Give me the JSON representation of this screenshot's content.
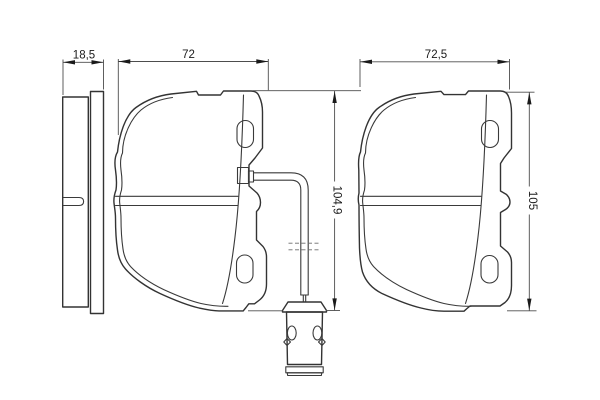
{
  "page": {
    "background": "#ffffff"
  },
  "drawing": {
    "type": "technical-drawing",
    "subject": "disc-brake-pad-set-with-wear-sensor",
    "views": {
      "side_view": {
        "thickness_label": "18,5"
      },
      "left_pad": {
        "width_label": "72",
        "height_label": "104,9"
      },
      "right_pad": {
        "width_label": "72,5",
        "height_label": "105"
      }
    },
    "colors": {
      "outline": "#333333",
      "dimension_line": "#4d4d4d",
      "text": "#1a1a1a",
      "background": "#ffffff"
    }
  }
}
